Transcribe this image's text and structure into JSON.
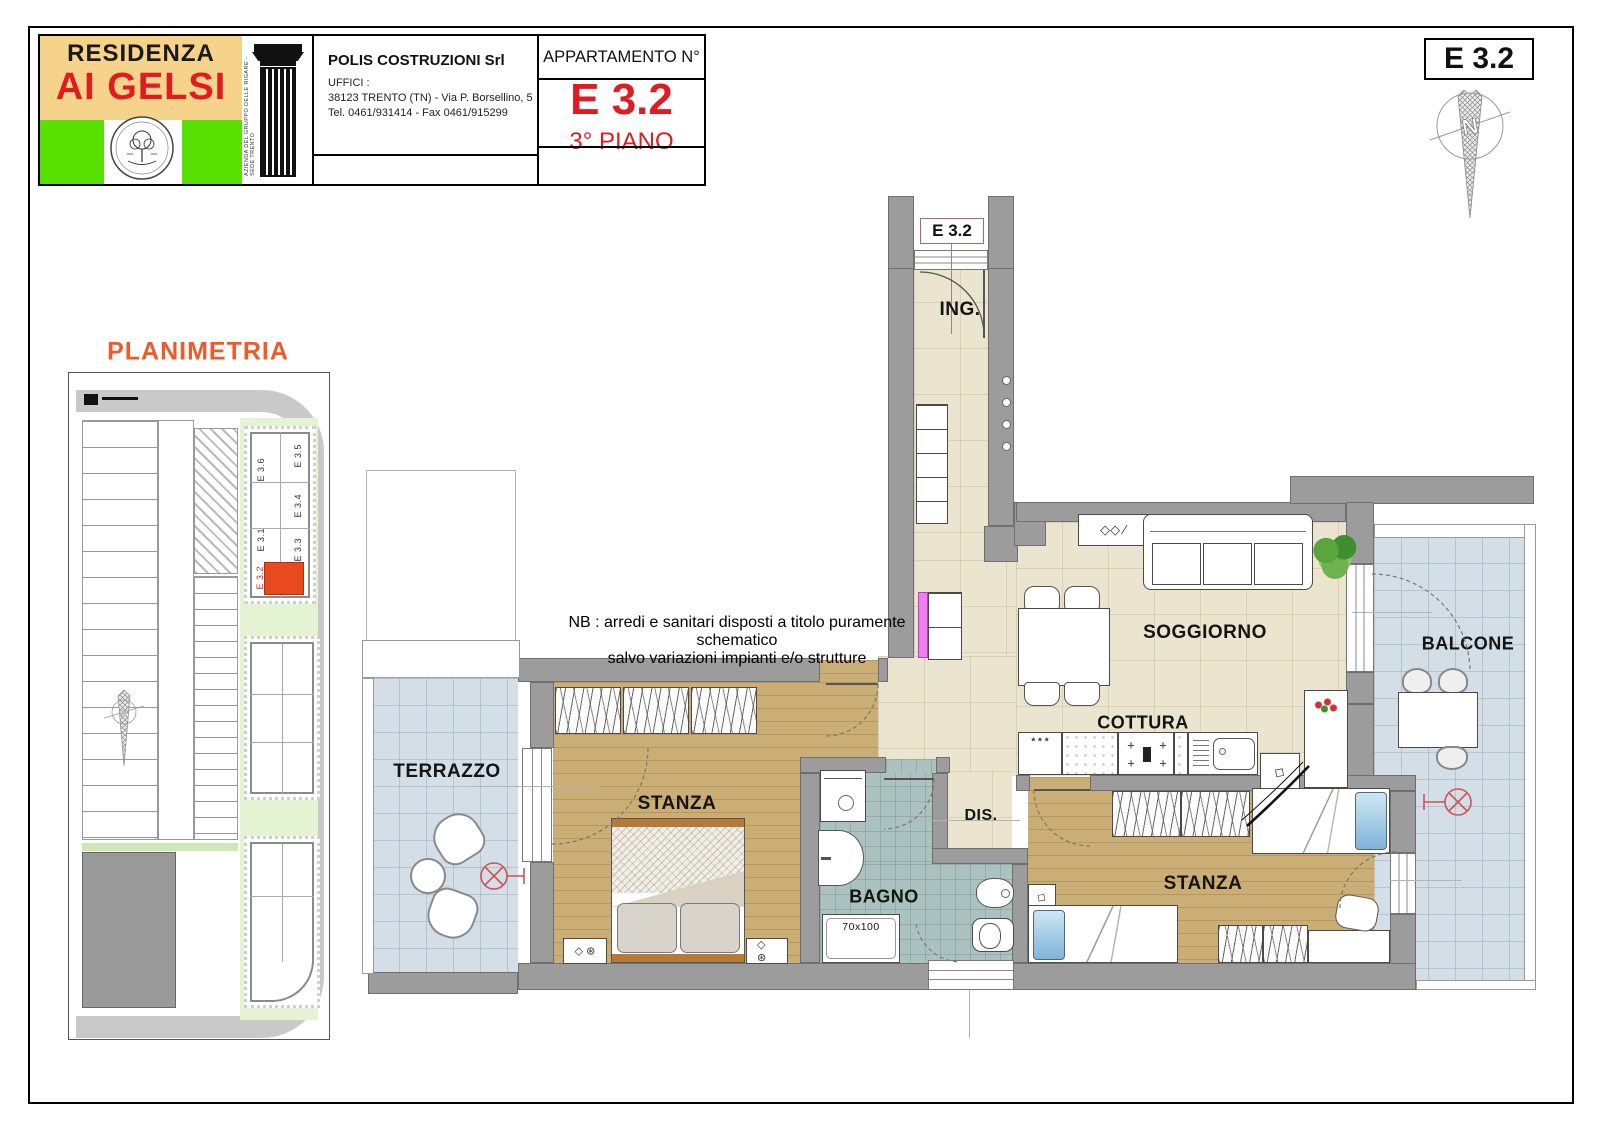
{
  "header": {
    "logo": {
      "line1": "RESIDENZA",
      "line2": "AI GELSI",
      "column_caption": "AZIENDA DEL GRUPPO DELLE RIGARE - SEDE TRENTO"
    },
    "company": {
      "name": "POLIS COSTRUZIONI Srl",
      "offices_label": "UFFICI :",
      "address": "38123 TRENTO (TN) - Via P. Borsellino, 5",
      "phone": "Tel. 0461/931414 - Fax 0461/915299"
    },
    "apartment": {
      "label": "APPARTAMENTO N°",
      "code": "E 3.2",
      "floor": "3° PIANO"
    }
  },
  "corner": {
    "code": "E 3.2",
    "compass_letter": "N"
  },
  "planimetria": {
    "title": "PLANIMETRIA",
    "units": [
      "E 3.6",
      "E 3.5",
      "E 3.4",
      "E 3.3",
      "E 3.1",
      "E 3.2"
    ],
    "highlight_unit": "E 3.2",
    "compass_letter": "N"
  },
  "plan": {
    "unit_tag": "E 3.2",
    "rooms": {
      "ingresso": "ING.",
      "soggiorno": "SOGGIORNO",
      "cottura": "COTTURA",
      "balcone": "BALCONE",
      "terrazzo": "TERRAZZO",
      "stanza1": "STANZA",
      "bagno": "BAGNO",
      "disimpegno": "DIS.",
      "stanza2": "STANZA"
    },
    "shower_size": "70x100",
    "kitchen": {
      "stars": "* * *"
    },
    "icons": {
      "plus": "+",
      "diamond": "◇",
      "nightstand": "◇ ⊛",
      "shelf": "◇◇ ∕"
    }
  },
  "note": {
    "line1": "NB : arredi e sanitari disposti a titolo puramente schematico",
    "line2": "salvo variazioni impianti e/o strutture"
  },
  "colors": {
    "accent_red": "#e01b22",
    "planimetria_orange": "#f05a28",
    "logo_green": "#58e000",
    "logo_tan": "#f6d38b",
    "wall_gray": "#9c9c9c",
    "floor_beige": "#ebe4ce",
    "floor_wood": "#cbae75",
    "floor_bath": "#abc2c1",
    "floor_terrace": "#d3dee6",
    "highlight_unit": "#e8491d",
    "radiator_magenta": "#ee7ff0"
  }
}
